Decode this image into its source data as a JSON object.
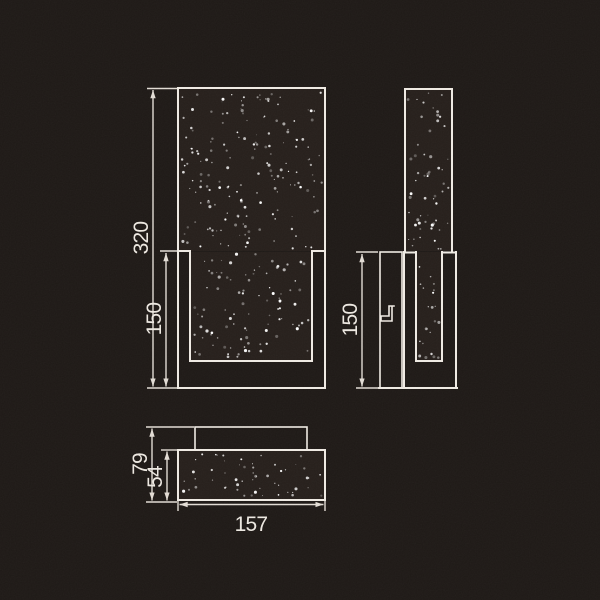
{
  "drawing": {
    "type": "technical-dimension-drawing",
    "subject": "rectangular crystal wall lamp",
    "colors": {
      "background": "#1e1916",
      "line": "#f0ebe4",
      "dim_line": "#e3ddd5",
      "text": "#eee9e2",
      "glass_fill": "#261f1b",
      "speckle": "#ffffff"
    },
    "views": {
      "front": {
        "dimensions": {
          "total_height": "320",
          "bracket_height": "150"
        }
      },
      "side": {
        "dimensions": {
          "bracket_height": "150"
        }
      },
      "bottom": {
        "dimensions": {
          "total_depth": "79",
          "glass_thickness": "54",
          "total_width": "157"
        }
      }
    }
  }
}
